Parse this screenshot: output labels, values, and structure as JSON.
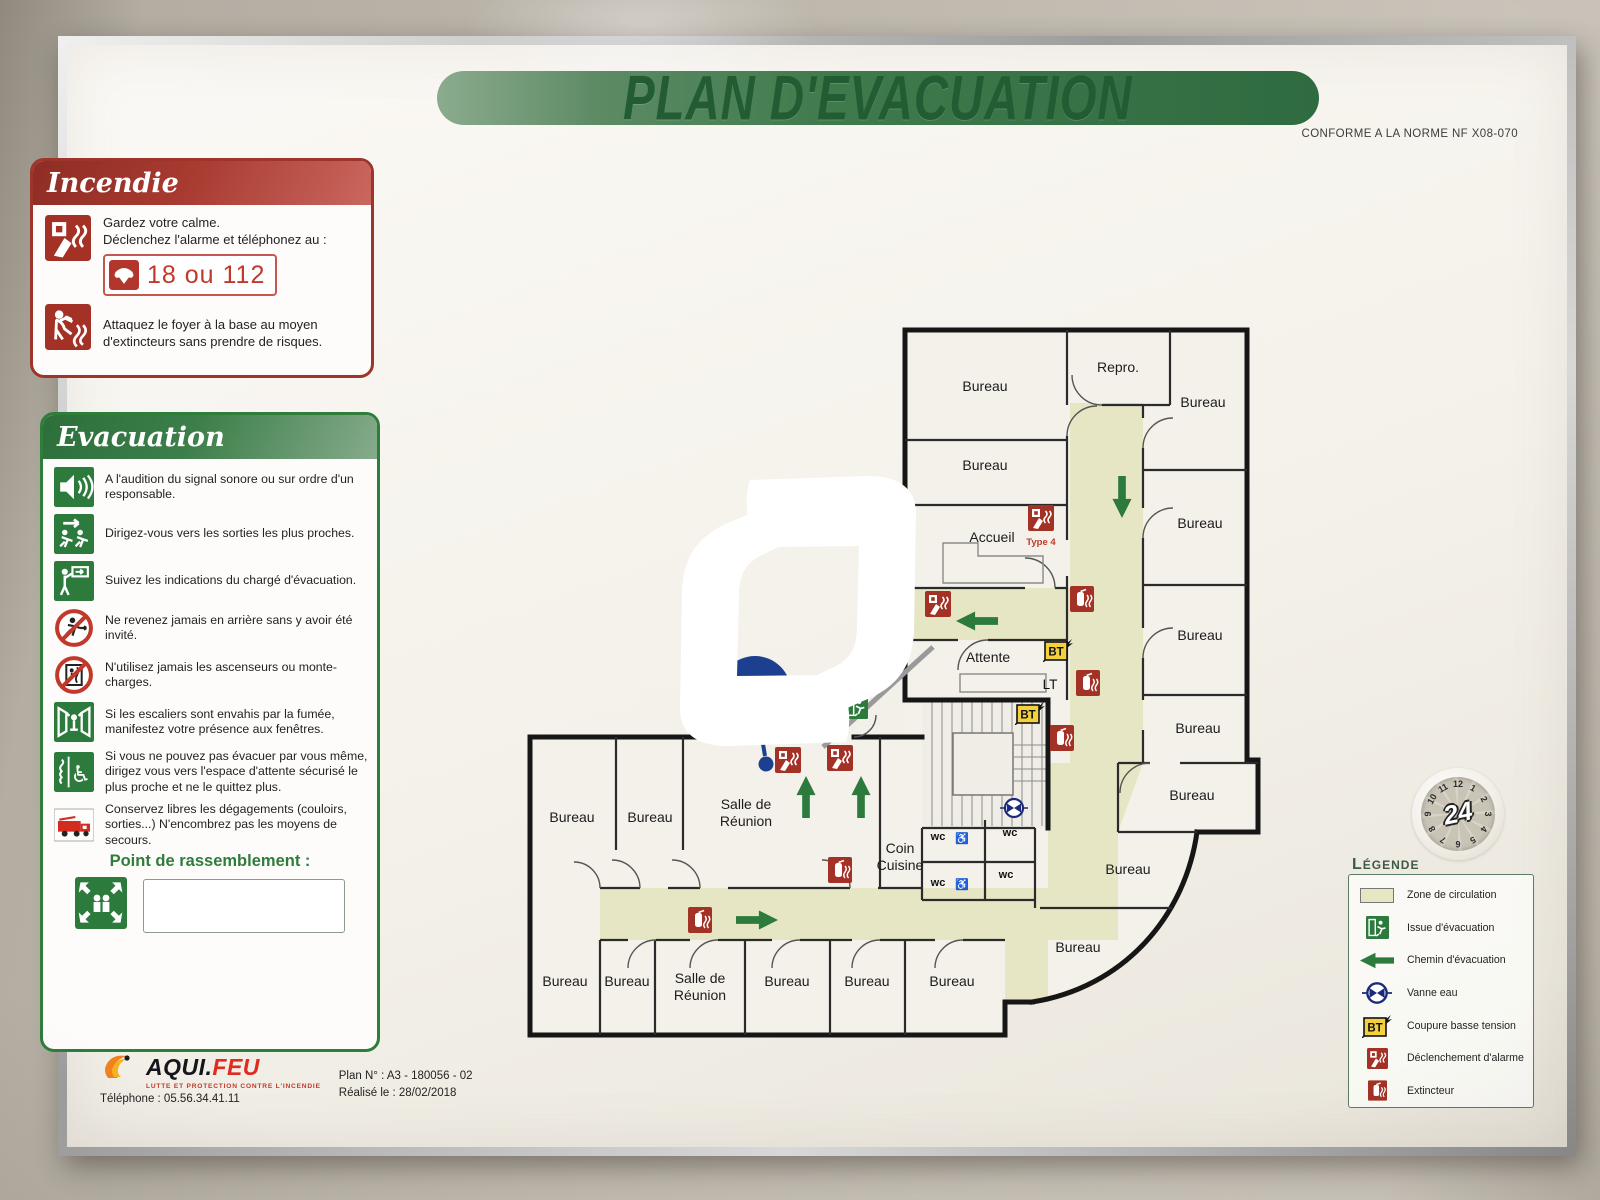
{
  "title": "PLAN D'EVACUATION",
  "conformity": "CONFORME A LA NORME NF X08-070",
  "incendie": {
    "title": "Incendie",
    "line1a": "Gardez votre calme.",
    "line1b": "Déclenchez l'alarme et téléphonez au :",
    "phone": "18 ou 112",
    "line2": "Attaquez le foyer à la base au moyen d'extincteurs sans prendre de risques."
  },
  "evacuation": {
    "title": "Evacuation",
    "items": [
      {
        "icon": "speaker-icon",
        "text": "A l'audition du signal sonore ou sur ordre d'un responsable."
      },
      {
        "icon": "running-exit-icon",
        "text": "Dirigez-vous vers les sorties les plus proches."
      },
      {
        "icon": "guide-icon",
        "text": "Suivez les indications du chargé d'évacuation."
      },
      {
        "icon": "no-return-icon",
        "text": "Ne revenez jamais en arrière sans y avoir été invité."
      },
      {
        "icon": "no-elevator-icon",
        "text": "N'utilisez jamais les ascenseurs ou monte-charges."
      },
      {
        "icon": "window-icon",
        "text": "Si les escaliers sont envahis par la fumée, manifestez votre présence aux fenêtres."
      },
      {
        "icon": "wheelchair-icon",
        "text": "Si vous ne pouvez pas évacuer par vous même, dirigez vous vers l'espace d'attente sécurisé le plus proche et ne le quittez plus."
      },
      {
        "icon": "firetruck-icon",
        "text": "Conservez libres les dégagements (couloirs, sorties...) N'encombrez pas les moyens de secours."
      }
    ],
    "assembly_label": "Point de rassemblement :"
  },
  "legend": {
    "title": "Légende",
    "items": [
      {
        "icon": "circulation-zone-swatch",
        "label": "Zone de circulation"
      },
      {
        "icon": "exit-icon",
        "label": "Issue d'évacuation"
      },
      {
        "icon": "evacuation-arrow-icon",
        "label": "Chemin d'évacuation"
      },
      {
        "icon": "water-valve-icon",
        "label": "Vanne eau"
      },
      {
        "icon": "bt-icon",
        "label": "Coupure basse tension"
      },
      {
        "icon": "alarm-icon",
        "label": "Déclenchement d'alarme"
      },
      {
        "icon": "extinguisher-icon",
        "label": "Extincteur"
      }
    ]
  },
  "footer": {
    "brand_main": "AQUI.",
    "brand_accent": "FEU",
    "tagline": "LUTTE ET PROTECTION CONTRE L'INCENDIE",
    "phone": "Téléphone : 05.56.34.41.11",
    "plan_no": "Plan N° : A3 - 180056 - 02",
    "date": "Réalisé le : 28/02/2018"
  },
  "sticker": {
    "center": "24",
    "numbers": [
      "12",
      "1",
      "2",
      "3",
      "4",
      "5",
      "6",
      "7",
      "8",
      "9",
      "10",
      "11"
    ]
  },
  "plan": {
    "bt_label": "BT",
    "rooms": [
      {
        "label": "Bureau",
        "x": 985,
        "y": 391
      },
      {
        "label": "Bureau",
        "x": 985,
        "y": 470
      },
      {
        "label": "Accueil",
        "x": 992,
        "y": 542
      },
      {
        "label": "Attente",
        "x": 988,
        "y": 662
      },
      {
        "label": "Repro.",
        "x": 1118,
        "y": 372
      },
      {
        "label": "Bureau",
        "x": 1203,
        "y": 407
      },
      {
        "label": "Bureau",
        "x": 1200,
        "y": 528
      },
      {
        "label": "Bureau",
        "x": 1200,
        "y": 640
      },
      {
        "label": "Bureau",
        "x": 1198,
        "y": 733
      },
      {
        "label": "Bureau",
        "x": 1192,
        "y": 800
      },
      {
        "label": "Bureau",
        "x": 1128,
        "y": 874
      },
      {
        "label": "Bureau",
        "x": 1078,
        "y": 952
      },
      {
        "label": "Bureau",
        "x": 572,
        "y": 822
      },
      {
        "label": "Bureau",
        "x": 650,
        "y": 822
      },
      {
        "label": "Salle de\nRéunion",
        "x": 746,
        "y": 812
      },
      {
        "label": "Coin\nCuisine",
        "x": 900,
        "y": 856
      },
      {
        "label": "Bureau",
        "x": 565,
        "y": 986
      },
      {
        "label": "Bureau",
        "x": 627,
        "y": 986
      },
      {
        "label": "Salle de\nRéunion",
        "x": 700,
        "y": 986
      },
      {
        "label": "Bureau",
        "x": 787,
        "y": 986
      },
      {
        "label": "Bureau",
        "x": 867,
        "y": 986
      },
      {
        "label": "Bureau",
        "x": 952,
        "y": 986
      }
    ],
    "icons": [
      {
        "type": "alarm",
        "x": 1041,
        "y": 518
      },
      {
        "type": "alarm",
        "x": 938,
        "y": 604
      },
      {
        "type": "alarm",
        "x": 788,
        "y": 760
      },
      {
        "type": "alarm",
        "x": 840,
        "y": 758
      },
      {
        "type": "ext",
        "x": 1082,
        "y": 599
      },
      {
        "type": "ext",
        "x": 1088,
        "y": 683
      },
      {
        "type": "ext",
        "x": 1062,
        "y": 738
      },
      {
        "type": "ext",
        "x": 840,
        "y": 870
      },
      {
        "type": "ext",
        "x": 700,
        "y": 920
      },
      {
        "type": "bt",
        "x": 1058,
        "y": 650
      },
      {
        "type": "bt",
        "x": 1030,
        "y": 713
      },
      {
        "type": "valve",
        "x": 1014,
        "y": 808
      },
      {
        "type": "exit",
        "x": 801,
        "y": 711
      },
      {
        "type": "exit",
        "x": 856,
        "y": 707
      }
    ],
    "arrows": [
      {
        "dir": "down",
        "x": 1122,
        "y": 497
      },
      {
        "dir": "left",
        "x": 977,
        "y": 621
      },
      {
        "dir": "up",
        "x": 806,
        "y": 797
      },
      {
        "dir": "up",
        "x": 861,
        "y": 797
      },
      {
        "dir": "right",
        "x": 757,
        "y": 920
      }
    ],
    "extra_labels": [
      {
        "text": "Type 4",
        "x": 1041,
        "y": 545,
        "cls": "red"
      },
      {
        "text": "LT",
        "x": 1050,
        "y": 689,
        "cls": "lt"
      },
      {
        "text": "wc",
        "x": 938,
        "y": 840,
        "cls": "wc"
      },
      {
        "text": "♿",
        "x": 962,
        "y": 842,
        "cls": "wc"
      },
      {
        "text": "wc",
        "x": 1010,
        "y": 836,
        "cls": "wc"
      },
      {
        "text": "wc",
        "x": 938,
        "y": 886,
        "cls": "wc"
      },
      {
        "text": "♿",
        "x": 962,
        "y": 888,
        "cls": "wc"
      },
      {
        "text": "wc",
        "x": 1006,
        "y": 878,
        "cls": "wc"
      }
    ]
  }
}
